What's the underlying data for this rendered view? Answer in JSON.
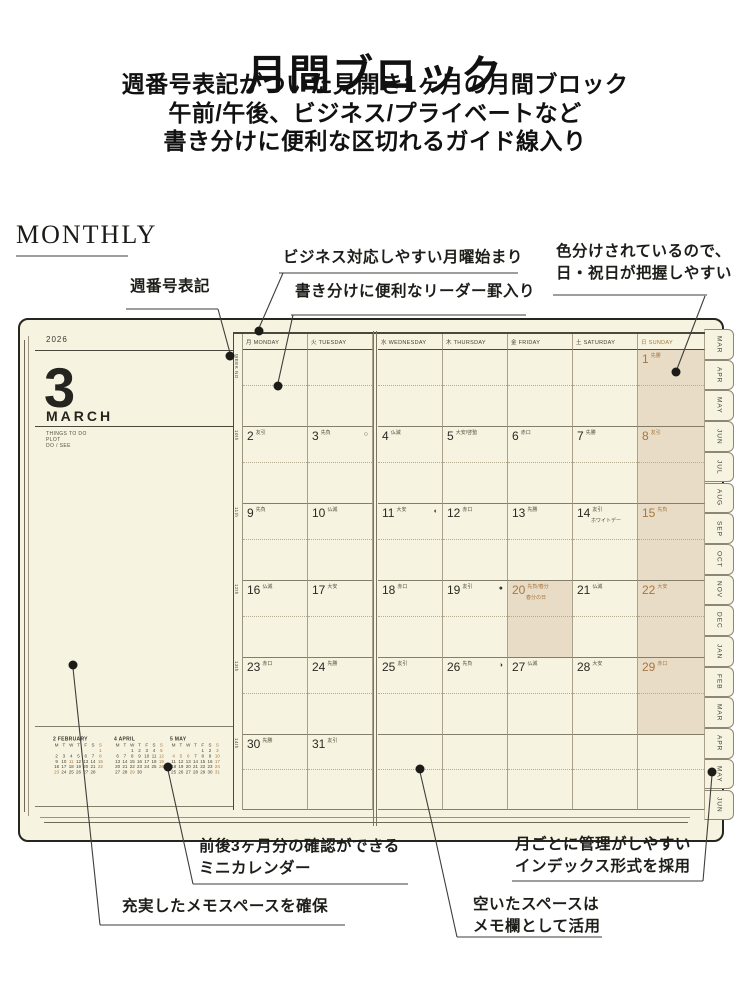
{
  "page": {
    "title": "月間ブロック",
    "subtitle": [
      "週番号表記がついた見開き1ヶ月の月間ブロック",
      "午前/午後、ビジネス/プライベートなど",
      "書き分けに便利な区切れるガイド線入り"
    ],
    "section_label": "MONTHLY"
  },
  "callouts": {
    "week_no": "週番号表記",
    "monday_start": "ビジネス対応しやすい月曜始まり",
    "leader_rule": "書き分けに便利なリーダー罫入り",
    "color_coded": [
      "色分けされているので、",
      "日・祝日が把握しやすい"
    ],
    "mini_calendar": [
      "前後3ヶ月分の確認ができる",
      "ミニカレンダー"
    ],
    "memo_space": "充実したメモスペースを確保",
    "index_tabs": [
      "月ごとに管理がしやすい",
      "インデックス形式を採用"
    ],
    "empty_space": [
      "空いたスペースは",
      "メモ欄として活用"
    ]
  },
  "planner": {
    "year": "2026",
    "month_number": "3",
    "month_name": "MARCH",
    "todo_labels": [
      "THINGS TO DO",
      "PLOT",
      "DO / SEE"
    ],
    "week_no_header": "WEEK NO",
    "weekday_headers": [
      {
        "jp": "月",
        "en": "MONDAY"
      },
      {
        "jp": "火",
        "en": "TUESDAY"
      },
      {
        "jp": "水",
        "en": "WEDNESDAY"
      },
      {
        "jp": "木",
        "en": "THURSDAY"
      },
      {
        "jp": "金",
        "en": "FRIDAY"
      },
      {
        "jp": "土",
        "en": "SATURDAY"
      },
      {
        "jp": "日",
        "en": "SUNDAY",
        "is_sunday": true
      }
    ],
    "weeks": [
      {
        "week_no": "",
        "days": [
          null,
          null,
          null,
          null,
          null,
          null,
          {
            "n": "1",
            "rokuyo": "先勝"
          }
        ]
      },
      {
        "week_no": "10th",
        "days": [
          {
            "n": "2",
            "rokuyo": "友引"
          },
          {
            "n": "3",
            "rokuyo": "先負",
            "moon": "○"
          },
          {
            "n": "4",
            "rokuyo": "仏滅"
          },
          {
            "n": "5",
            "rokuyo": "大安/啓蟄"
          },
          {
            "n": "6",
            "rokuyo": "赤口"
          },
          {
            "n": "7",
            "rokuyo": "先勝"
          },
          {
            "n": "8",
            "rokuyo": "友引"
          }
        ]
      },
      {
        "week_no": "11th",
        "days": [
          {
            "n": "9",
            "rokuyo": "先負"
          },
          {
            "n": "10",
            "rokuyo": "仏滅"
          },
          {
            "n": "11",
            "rokuyo": "大安",
            "moon": "◐"
          },
          {
            "n": "12",
            "rokuyo": "赤口"
          },
          {
            "n": "13",
            "rokuyo": "先勝"
          },
          {
            "n": "14",
            "rokuyo": "友引",
            "note": "ホワイトデー"
          },
          {
            "n": "15",
            "rokuyo": "先負"
          }
        ]
      },
      {
        "week_no": "12th",
        "days": [
          {
            "n": "16",
            "rokuyo": "仏滅"
          },
          {
            "n": "17",
            "rokuyo": "大安"
          },
          {
            "n": "18",
            "rokuyo": "赤口"
          },
          {
            "n": "19",
            "rokuyo": "友引",
            "moon": "●"
          },
          {
            "n": "20",
            "rokuyo": "先負/春分",
            "note": "春分の日",
            "holiday": true
          },
          {
            "n": "21",
            "rokuyo": "仏滅"
          },
          {
            "n": "22",
            "rokuyo": "大安"
          }
        ]
      },
      {
        "week_no": "13th",
        "days": [
          {
            "n": "23",
            "rokuyo": "赤口"
          },
          {
            "n": "24",
            "rokuyo": "先勝"
          },
          {
            "n": "25",
            "rokuyo": "友引"
          },
          {
            "n": "26",
            "rokuyo": "先負",
            "moon": "◑"
          },
          {
            "n": "27",
            "rokuyo": "仏滅"
          },
          {
            "n": "28",
            "rokuyo": "大安"
          },
          {
            "n": "29",
            "rokuyo": "赤口"
          }
        ]
      },
      {
        "week_no": "14th",
        "days": [
          {
            "n": "30",
            "rokuyo": "先勝"
          },
          {
            "n": "31",
            "rokuyo": "友引"
          },
          null,
          null,
          null,
          null,
          null
        ]
      }
    ],
    "mini_calendars": [
      {
        "label": "2 FEBRUARY",
        "weekdays": "MTWTFSS",
        "start_col": 7,
        "days": 28,
        "red": [
          1,
          8,
          11,
          15,
          22,
          23
        ]
      },
      {
        "label": "4 APRIL",
        "weekdays": "MTWTFSS",
        "start_col": 3,
        "days": 30,
        "red": [
          5,
          12,
          19,
          26,
          29
        ]
      },
      {
        "label": "5 MAY",
        "weekdays": "MTWTFSS",
        "start_col": 5,
        "days": 31,
        "red": [
          3,
          4,
          5,
          6,
          10,
          17,
          24,
          31
        ]
      }
    ],
    "index_tabs": [
      "MAR",
      "APR",
      "MAY",
      "JUN",
      "JUL",
      "AUG",
      "SEP",
      "OCT",
      "NOV",
      "DEC",
      "JAN",
      "FEB",
      "MAR",
      "APR",
      "MAY",
      "JUN"
    ]
  },
  "colors": {
    "paper": "#f6f3e0",
    "sunday_shade": "#e8dcc7",
    "accent_brown": "#a8763f",
    "ink": "#26241e"
  }
}
